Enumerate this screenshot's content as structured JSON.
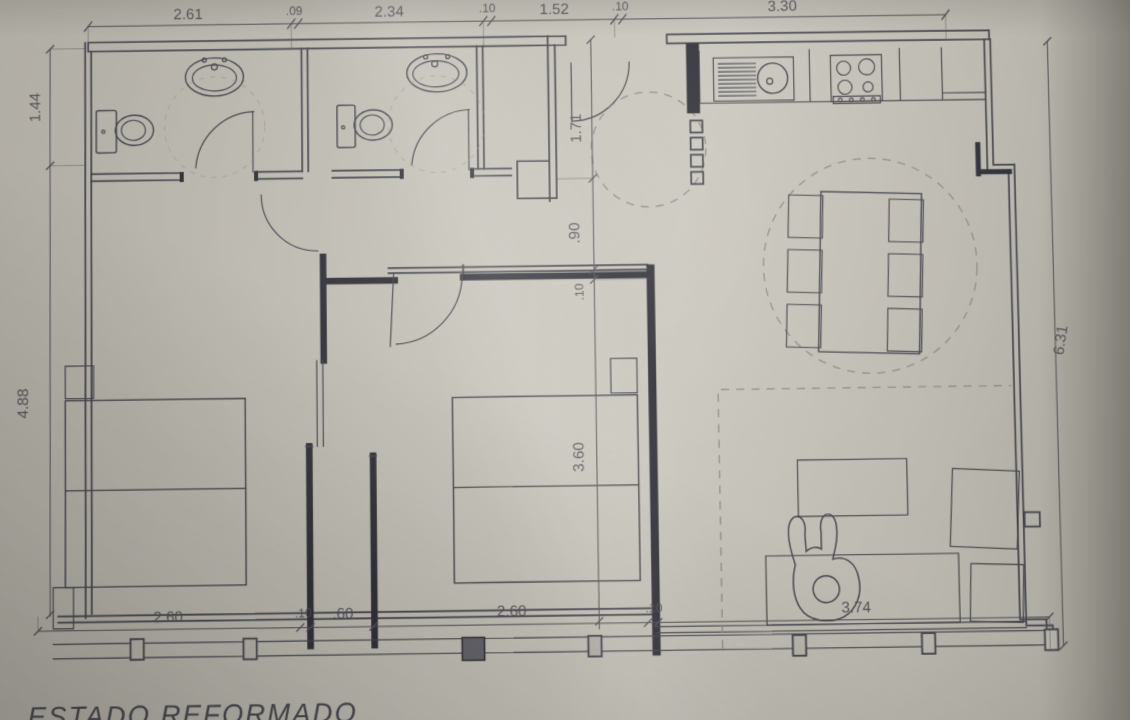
{
  "title": {
    "label": "ESTADO REFORMADO"
  },
  "dimensions": {
    "top": [
      "2.61",
      ".09",
      "2.34",
      ".10",
      "1.52",
      ".10",
      "3.30"
    ],
    "left": [
      "1.44",
      "4.88"
    ],
    "center": [
      "1.71",
      ".90",
      ".10",
      "3.60"
    ],
    "right": [
      "6.31"
    ],
    "bottom": [
      "2.60",
      ".10",
      ".60",
      "2.60",
      ".10",
      "3.74"
    ]
  },
  "colors": {
    "paper": "#c3c0b7",
    "ink": "#43434b",
    "ink_dark": "#2e2e36",
    "dim": "#514e55",
    "dashed": "#8f8d86"
  }
}
